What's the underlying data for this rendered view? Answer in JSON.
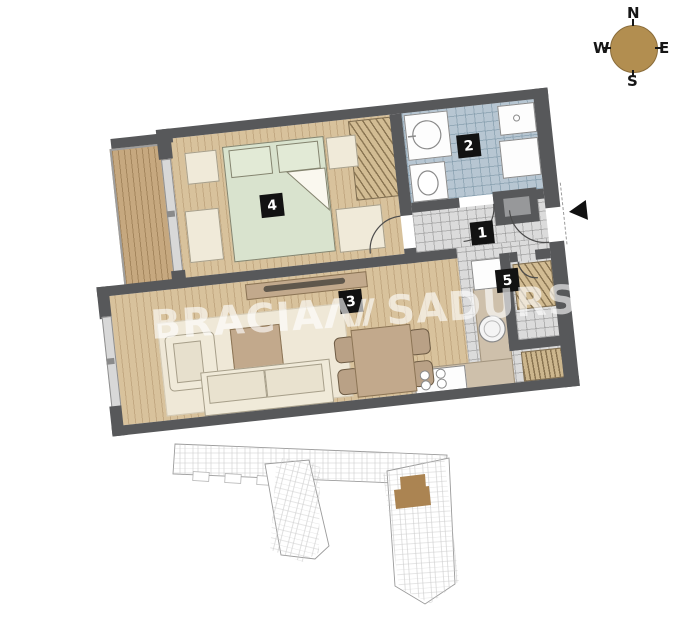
{
  "compass": {
    "north": "N",
    "east": "E",
    "south": "S",
    "west": "W"
  },
  "watermark": {
    "left": "BRACIA",
    "logo": "Λ",
    "right": "SADURSCY"
  },
  "rooms": [
    {
      "label": "1"
    },
    {
      "label": "2"
    },
    {
      "label": "3"
    },
    {
      "label": "4"
    },
    {
      "label": "5"
    }
  ],
  "colors": {
    "wall": "#57585a",
    "wood_floor": "#d8c29c",
    "balcony_floor": "#c6a87f",
    "bathroom_tile": "#b7c6d2",
    "hall_tile": "#dbdbdb",
    "bed": "#d9e3ce",
    "furniture_cream": "#f0ead9",
    "furniture_brown": "#c2a98c",
    "kitchen_counter": "#cec0ab",
    "compass_disc": "#b28e50",
    "site_highlight": "#ab8452",
    "room_label_bg": "#121212",
    "watermark_text": "rgba(255,255,255,0.62)"
  }
}
